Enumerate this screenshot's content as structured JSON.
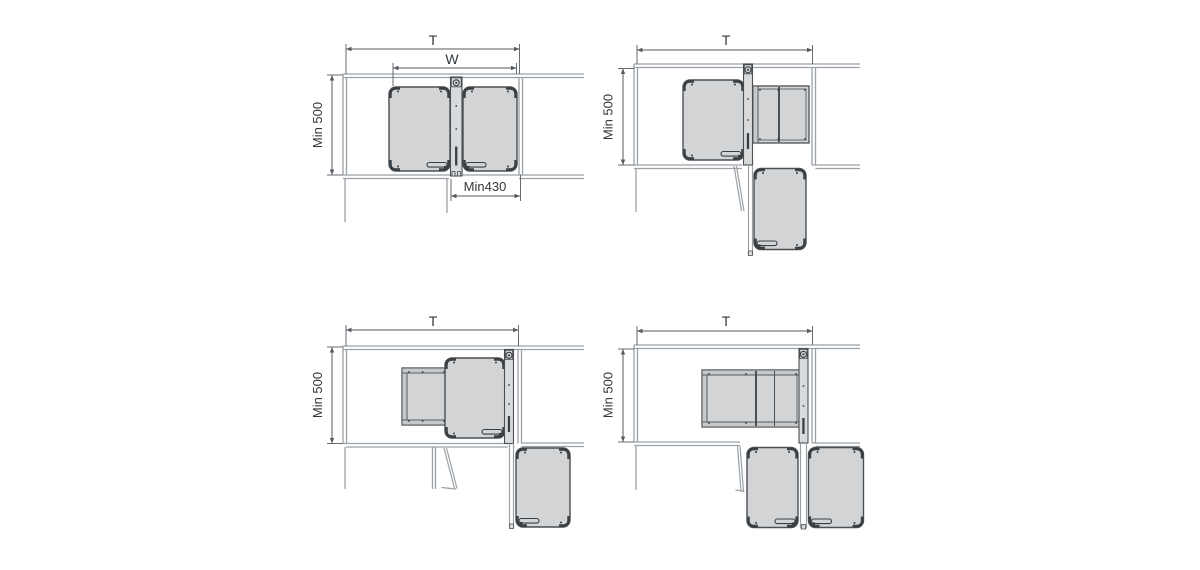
{
  "figure": {
    "description": "Corner cabinet pull-out unit installation plan views",
    "panel_count": 4
  },
  "diagrams": [
    {
      "id": "top-left",
      "labels": {
        "top_width": "T",
        "inner_width": "W",
        "min_depth": "Min 500",
        "min_opening": "Min430"
      }
    },
    {
      "id": "top-right",
      "labels": {
        "top_width": "T",
        "min_depth": "Min 500"
      }
    },
    {
      "id": "bottom-left",
      "labels": {
        "top_width": "T",
        "min_depth": "Min 500"
      }
    },
    {
      "id": "bottom-right",
      "labels": {
        "top_width": "T",
        "min_depth": "Min 500"
      }
    }
  ],
  "colors": {
    "background": "#ffffff",
    "wall_line": "#9aa1a7",
    "dimension_line": "#565b60",
    "text": "#33383c",
    "tray_fill": "#d3d4d5",
    "tray_band_fill": "#c7c8c9",
    "tray_border": "#4a4f53",
    "rail_fill": "#d9dadb",
    "detail_dark": "#3a3f43"
  }
}
